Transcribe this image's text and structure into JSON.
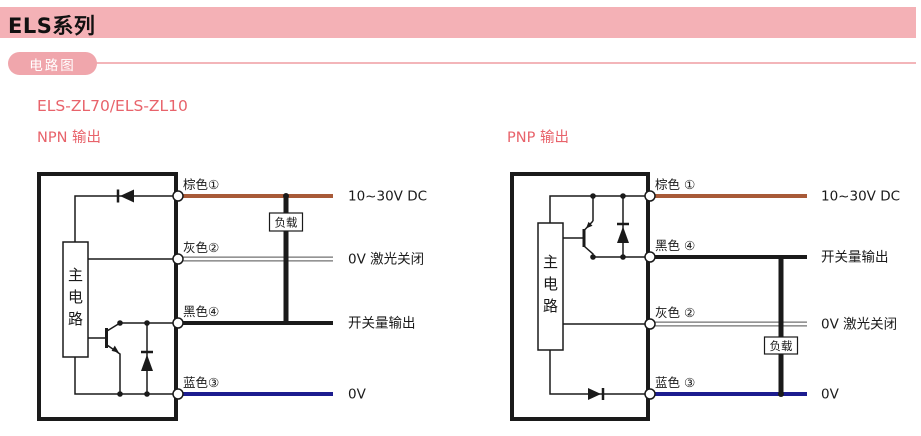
{
  "header": {
    "title": "ELS系列"
  },
  "section": {
    "label": "电路图"
  },
  "subtitle": "ELS-ZL70/ELS-ZL10",
  "colors": {
    "header_bg": "#f4b1b6",
    "pill_bg": "#f0a6ac",
    "divider": "#f3b5b9",
    "accent_text": "#e8636b",
    "diagram_ink": "#1a1a1a",
    "wire_brown": "#a85a38",
    "wire_gray": "#707070",
    "wire_black": "#1a1a1a",
    "wire_blue": "#1c1c8f"
  },
  "diagrams": [
    {
      "title": "NPN 输出",
      "type": "NPN",
      "main_circuit": "主电路",
      "load": "负载",
      "wires": [
        {
          "label": "棕色①",
          "color_name": "brown",
          "hex": "#a85a38",
          "signal": "10~30V DC"
        },
        {
          "label": "灰色②",
          "color_name": "gray",
          "hex": "#707070",
          "signal": "0V 激光关闭"
        },
        {
          "label": "黑色④",
          "color_name": "black",
          "hex": "#1a1a1a",
          "signal": "开关量输出"
        },
        {
          "label": "蓝色③",
          "color_name": "blue",
          "hex": "#1c1c8f",
          "signal": "0V"
        }
      ]
    },
    {
      "title": "PNP 输出",
      "type": "PNP",
      "main_circuit": "主电路",
      "load": "负载",
      "wires": [
        {
          "label": "棕色 ①",
          "color_name": "brown",
          "hex": "#a85a38",
          "signal": "10~30V DC"
        },
        {
          "label": "黑色 ④",
          "color_name": "black",
          "hex": "#1a1a1a",
          "signal": "开关量输出"
        },
        {
          "label": "灰色 ②",
          "color_name": "gray",
          "hex": "#707070",
          "signal": "0V 激光关闭"
        },
        {
          "label": "蓝色 ③",
          "color_name": "blue",
          "hex": "#1c1c8f",
          "signal": "0V"
        }
      ]
    }
  ]
}
